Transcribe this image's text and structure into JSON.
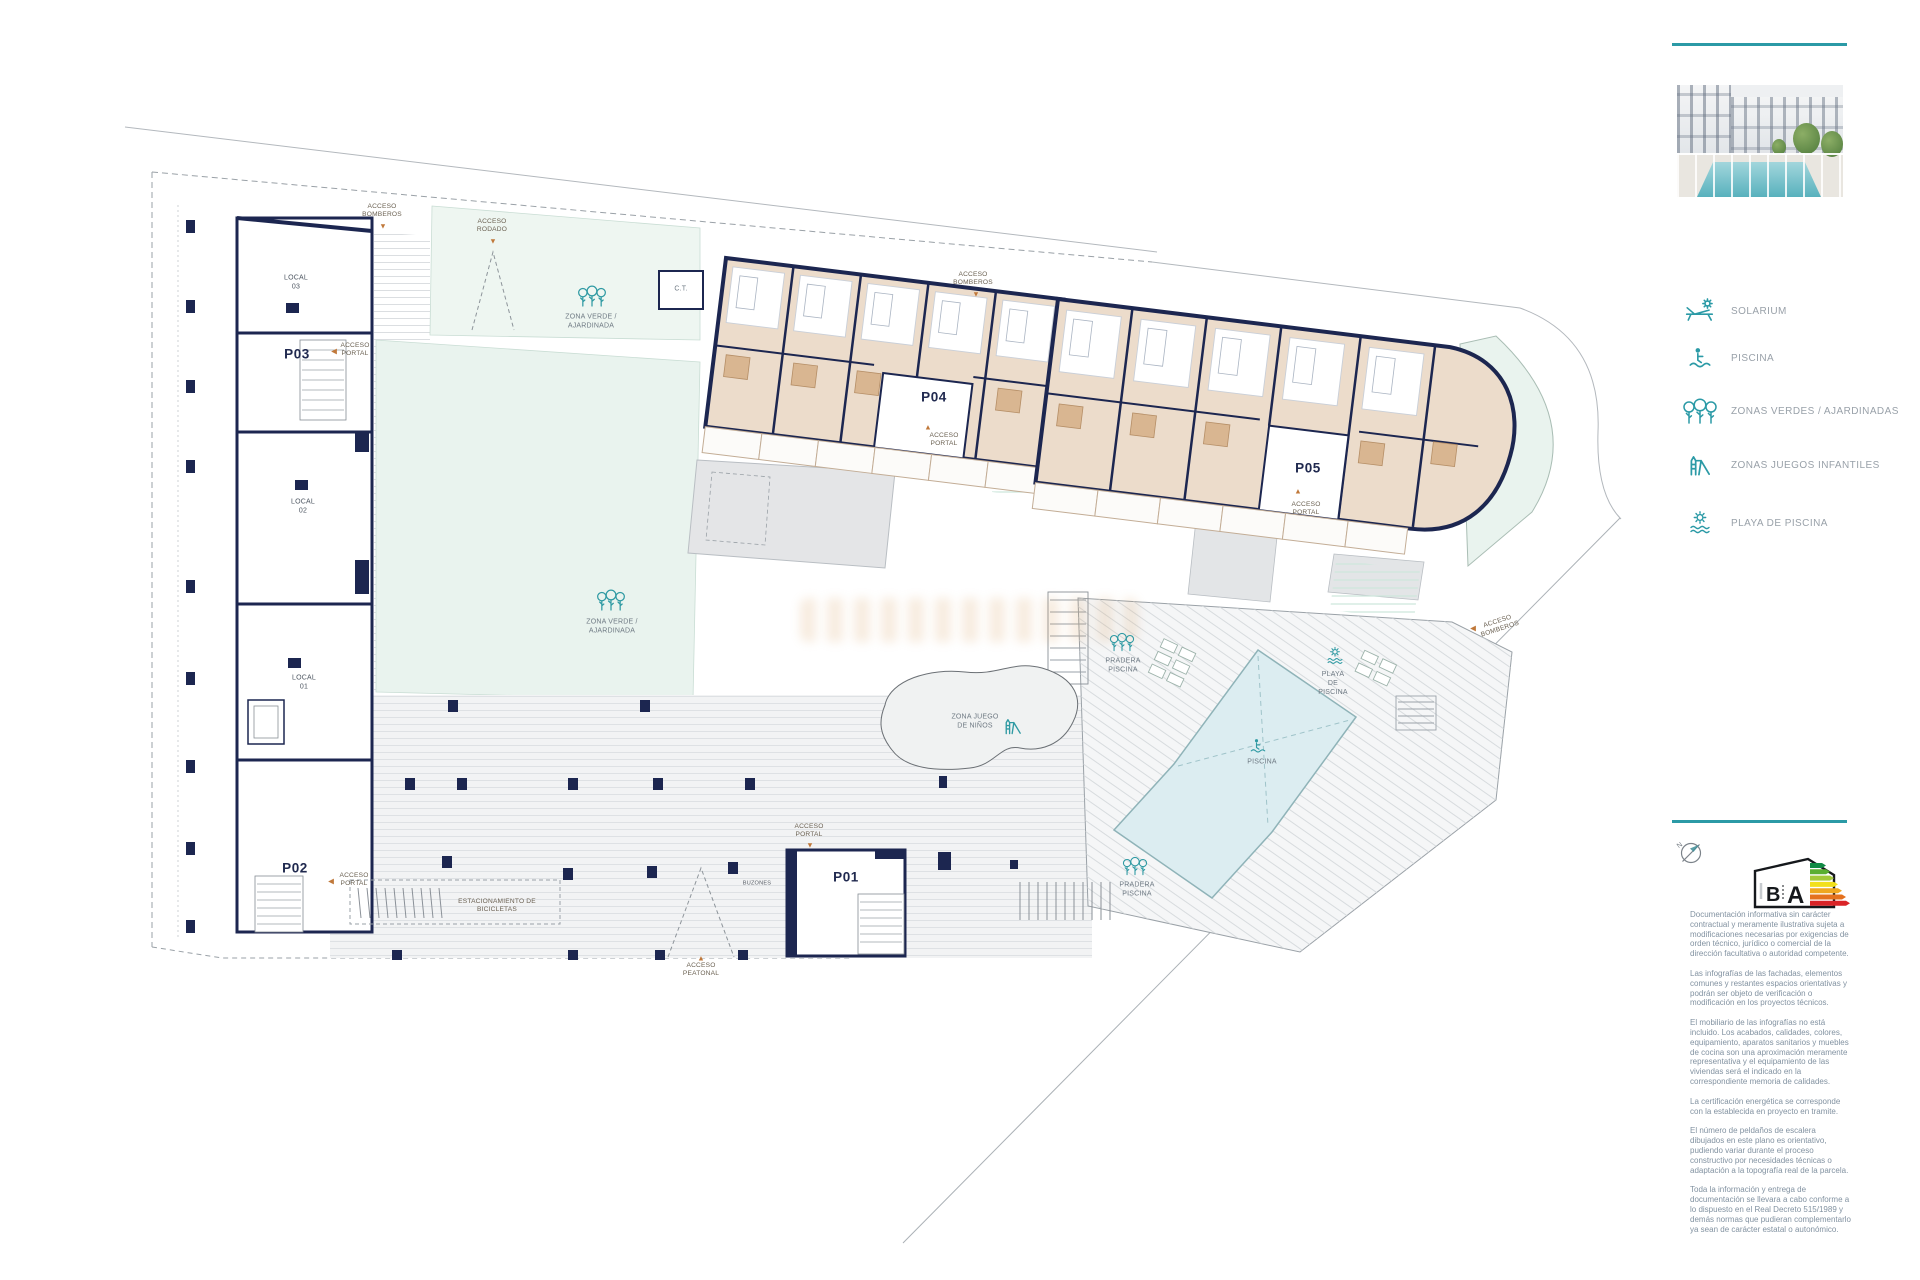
{
  "colors": {
    "accent_teal": "#2B9AA6",
    "wall_navy": "#1C2650",
    "apartment_beige": "#ECDCCB",
    "bath_tan": "#D9B691",
    "green_zone_mint": "#E9F3EE",
    "pool_blue": "#DCEDF1",
    "deck_gray": "#E4E5E7",
    "access_arrow_orange": "#C0783A"
  },
  "icons": {
    "arrow_down": "▼",
    "arrow_up": "▲",
    "arrow_left": "◀"
  },
  "sidebar": {
    "legend": [
      {
        "icon": "solarium-icon",
        "label": "SOLARIUM"
      },
      {
        "icon": "pool-person-icon",
        "label": "PISCINA"
      },
      {
        "icon": "trees-icon",
        "label": "ZONAS VERDES / AJARDINADAS"
      },
      {
        "icon": "slide-icon",
        "label": "ZONAS JUEGOS INFANTILES"
      },
      {
        "icon": "sun-waves-icon",
        "label": "PLAYA DE PISCINA"
      }
    ],
    "compass_label": "N",
    "energy": {
      "letter_left": "B",
      "letter_right": "A"
    },
    "disclaimer": [
      "Documentación informativa sin carácter contractual y meramente ilustrativa sujeta a modificaciones necesarias por exigencias de orden técnico, jurídico o comercial de la dirección facultativa o autoridad competente.",
      "Las infografías de las fachadas, elementos comunes y restantes espacios orientativas y podrán ser objeto de verificación o modificación en los proyectos técnicos.",
      "El mobiliario de las infografías no está incluido. Los acabados, calidades, colores, equipamiento, aparatos sanitarios y muebles de cocina son una aproximación meramente representativa y el equipamiento de las viviendas será el indicado en la correspondiente memoria de calidades.",
      "La certificación energética se corresponde con la establecida en proyecto en tramite.",
      "El número de peldaños de escalera dibujados en este plano es orientativo, pudiendo variar durante el proceso constructivo por necesidades técnicas o adaptación a la topografía real de la parcela.",
      "Toda la información y entrega de documentación se llevara a cabo conforme a lo dispuesto en el Real Decreto 515/1989 y demás normas que pudieran complementarlo ya sean de carácter estatal o autonómico."
    ]
  },
  "plan": {
    "portals": {
      "p01": "P01",
      "p02": "P02",
      "p03": "P03",
      "p04": "P04",
      "p05": "P05"
    },
    "locals": {
      "l1": "LOCAL\n01",
      "l2": "LOCAL\n02",
      "l3": "LOCAL\n03"
    },
    "access": {
      "bomberos": "ACCESO\nBOMBEROS",
      "rodado": "ACCESO\nRODADO",
      "portal": "ACCESO\nPORTAL",
      "peatonal": "ACCESO\nPEATONAL"
    },
    "zones": {
      "zona_verde": "ZONA VERDE /\nAJARDINADA",
      "zona_juego": "ZONA JUEGO\nDE NIÑOS",
      "pradera": "PRADERA\nPISCINA",
      "playa": "PLAYA\nDE\nPISCINA",
      "piscina": "PISCINA",
      "ct": "C.T.",
      "bicicletas": "ESTACIONAMIENTO DE\nBICICLETAS",
      "buzones": "BUZONES"
    }
  }
}
